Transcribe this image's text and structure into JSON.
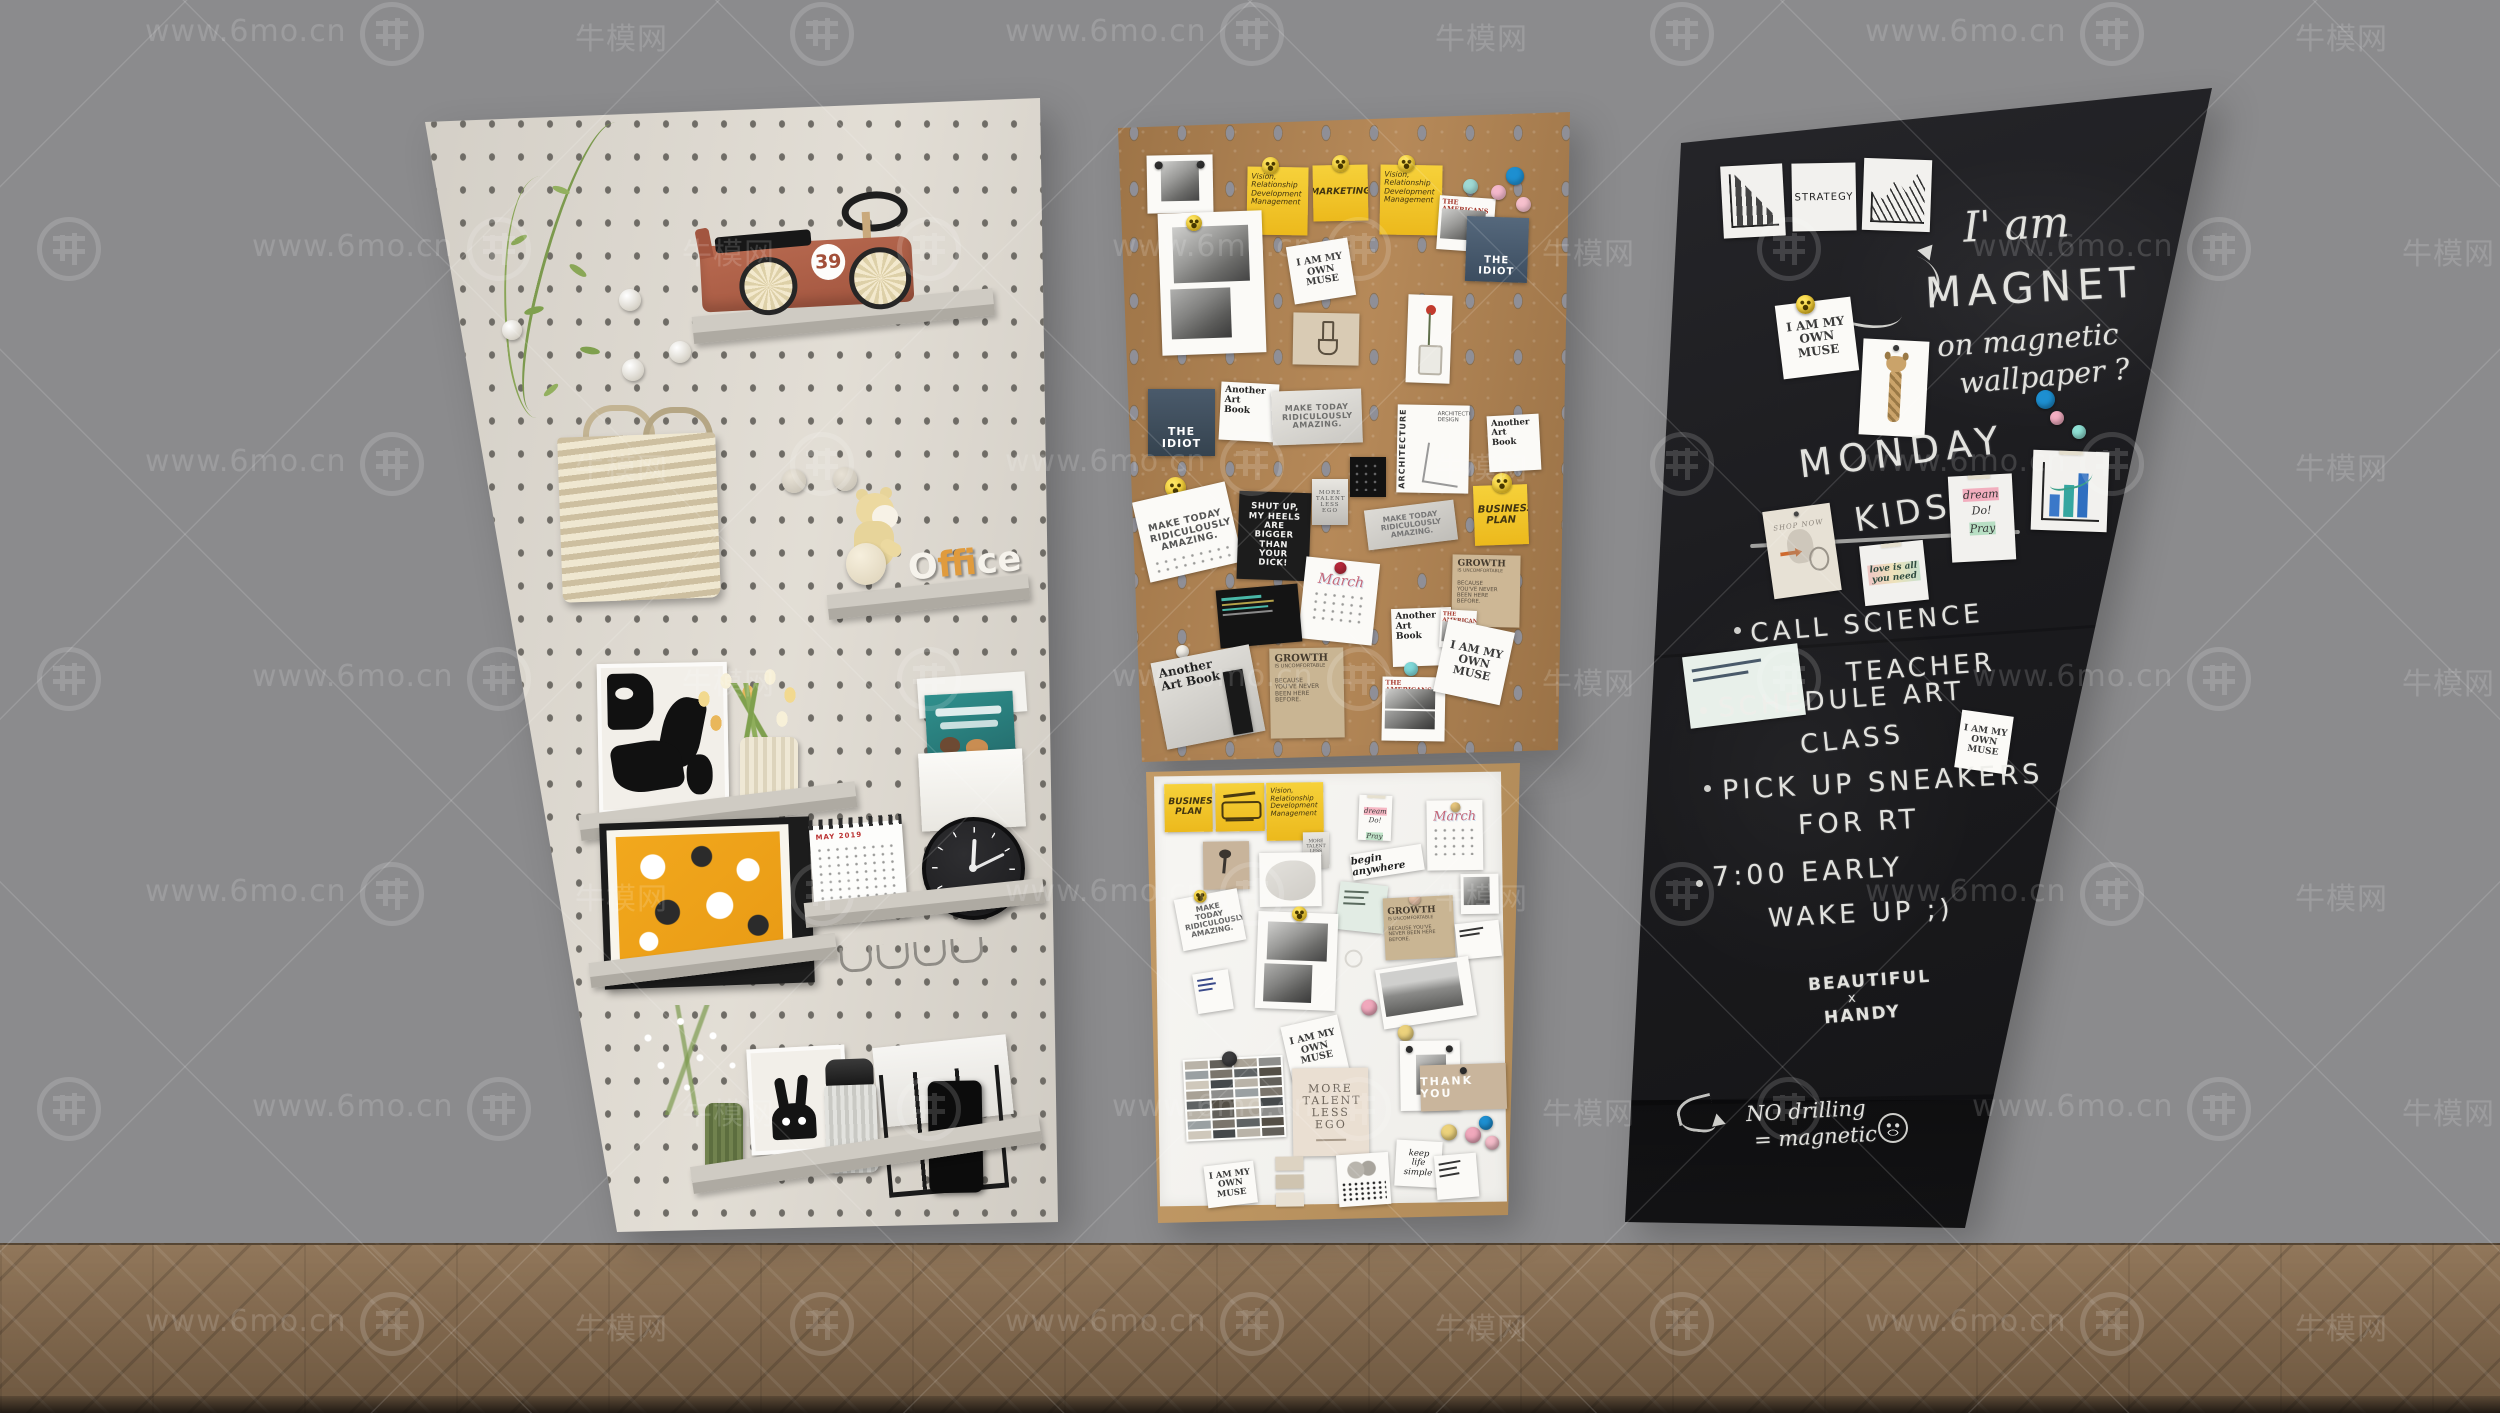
{
  "watermark": {
    "url": "www.6mo.cn",
    "brand": "牛模网"
  },
  "pegboard": {
    "car_number": "39",
    "office_o": "O",
    "office_f": "f",
    "office_rest": "fice",
    "calendar_title": "MAY 2019"
  },
  "notes": {
    "vision": "Vision, Relationship Development Management",
    "marketing": "MARKETING",
    "muse": "I AM MY OWN MUSE",
    "idiot": "THE IDIOT",
    "americans": "THE AMERICANS",
    "another_art_book": "Another Art Book",
    "make_today": "MAKE TODAY RIDICULOUSLY AMAZING.",
    "shut_up": "SHUT UP, MY HEELS ARE BIGGER THAN YOUR DICK!",
    "architecture": "ARCHITECTURE",
    "architecture_design": "ARCHITECTURE DESIGN",
    "business_plan": "BUSINESS PLAN",
    "more_talent": "MORE TALENT LESS EGO",
    "march": "March",
    "growth_title": "GROWTH",
    "growth_sub": "IS UNCOMFORTABLE",
    "growth_body": "BECAUSE YOU'VE NEVER BEEN HERE BEFORE.",
    "thank_you": "THANK YOU",
    "keep_life_simple": "keep life simple",
    "begin_anywhere": "begin anywhere",
    "dream": "dream",
    "do": "Do!",
    "pray": "Pray",
    "shop_now": "SHOP NOW",
    "love_note": "love is all you need",
    "strategy": "STRATEGY"
  },
  "chalk": {
    "line1": "I' am",
    "line2": "MAGNET",
    "line3": "on magnetic",
    "line4": "wallpaper ?",
    "monday": "MONDAY",
    "kids": "KIDS",
    "todo1a": "CALL SCIENCE",
    "todo1b": "TEACHER",
    "todo2a": "SCHEDULE ART",
    "todo2b": "CLASS",
    "todo3a": "PICK UP SNEAKERS",
    "todo3b": "FOR RT",
    "todo4a": "7:00 EARLY",
    "todo4b": "WAKE UP ;)",
    "beautiful": "BEAUTIFUL",
    "times": "x",
    "handy": "HANDY",
    "nodrill1": "NO drilling",
    "nodrill2": "= magnetic"
  },
  "palette": [
    "#b9b3a8",
    "#8e8e8c",
    "#5f6364",
    "#45494b",
    "#a8a195",
    "#7b756c",
    "#cfc8bb",
    "#63605a",
    "#9aa0a2",
    "#544f46"
  ]
}
